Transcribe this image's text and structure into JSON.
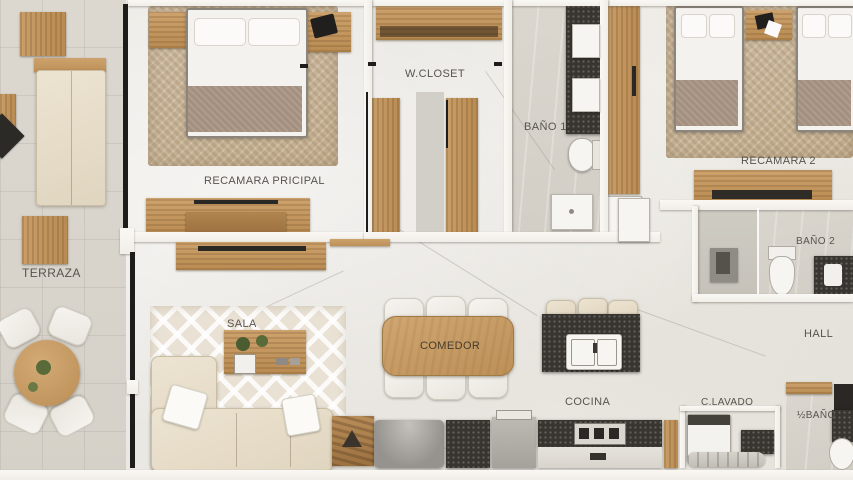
{
  "plan": {
    "rooms": [
      {
        "id": "terraza",
        "label": "TERRAZA"
      },
      {
        "id": "recamara_principal",
        "label": "RECAMARA PRICIPAL"
      },
      {
        "id": "w_closet",
        "label": "W.CLOSET"
      },
      {
        "id": "bano_1",
        "label": "BAÑO 1"
      },
      {
        "id": "recamara_2",
        "label": "RECAMARA 2"
      },
      {
        "id": "bano_2",
        "label": "BAÑO 2"
      },
      {
        "id": "hall",
        "label": "HALL"
      },
      {
        "id": "sala",
        "label": "SALA"
      },
      {
        "id": "comedor",
        "label": "COMEDOR"
      },
      {
        "id": "cocina",
        "label": "COCINA"
      },
      {
        "id": "c_lavado",
        "label": "C.LAVADO"
      },
      {
        "id": "medio_bano",
        "label": "½BAÑO"
      }
    ]
  },
  "palette": {
    "floor": "#ecebe6",
    "terrace_floor": "#dbd7cf",
    "wall": "#f8f6f1",
    "window": "#1f1d1b",
    "wood": "#c49a66",
    "wood_dark": "#a8824f",
    "fabric_white": "#f3f1ec",
    "fabric_beige": "#e7decb",
    "blanket": "#a3907f",
    "rug": "#c9b69a",
    "counter_dark": "#38342f",
    "steel": "#a9a6a1",
    "plant_green": "#5a6b3a",
    "label_color": "#57544e"
  }
}
